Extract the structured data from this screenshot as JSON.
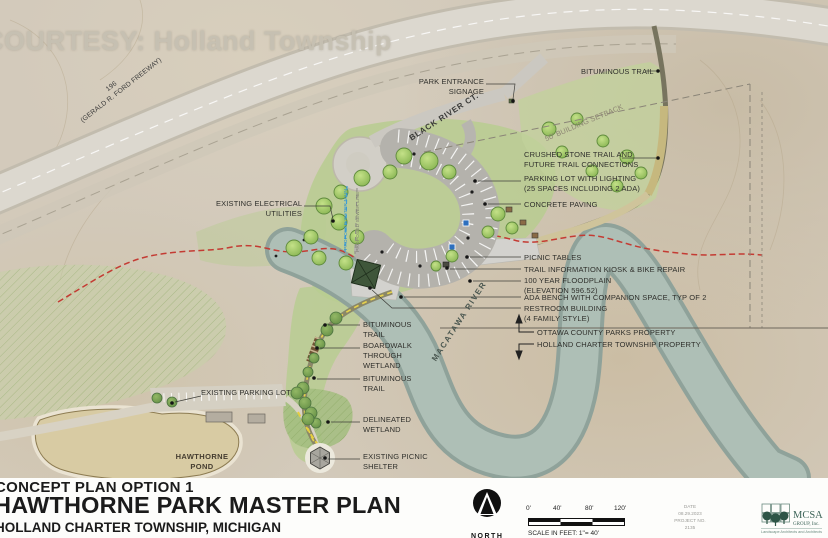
{
  "watermark": "COURTESY: Holland Township",
  "map": {
    "freeway_number": "196",
    "freeway_name": "(GERALD R. FORD FREEWAY)",
    "street_name": "BLACK RIVER CT.",
    "building_setback": "50' BUILDING SETBACK",
    "river_name": "MACATAWA RIVER",
    "pond_name_line1": "HAWTHORNE",
    "pond_name_line2": "POND",
    "water_main": "PROPOSED WATER MAIN",
    "sewer_line": "PROPOSED SEWER LINE"
  },
  "callouts": {
    "park_entrance": {
      "l1": "PARK ENTRANCE",
      "l2": "SIGNAGE"
    },
    "bituminous_trail_ne": {
      "l1": "BITUMINOUS TRAIL"
    },
    "crushed_stone": {
      "l1": "CRUSHED STONE TRAIL AND",
      "l2": "FUTURE TRAIL CONNECTIONS"
    },
    "parking_lot": {
      "l1": "PARKING LOT WITH LIGHTING",
      "l2": "(25 SPACES INCLUDING 2 ADA)"
    },
    "concrete_paving": {
      "l1": "CONCRETE PAVING"
    },
    "electrical": {
      "l1": "EXISTING ELECTRICAL",
      "l2": "UTILITIES"
    },
    "picnic_tables": {
      "l1": "PICNIC TABLES"
    },
    "kiosk": {
      "l1": "TRAIL INFORMATION KIOSK & BIKE REPAIR"
    },
    "floodplain": {
      "l1": "100 YEAR FLOODPLAIN",
      "l2": "(ELEVATION 596.52)"
    },
    "ada_bench": {
      "l1": "ADA BENCH WITH COMPANION SPACE, TYP OF 2"
    },
    "restroom": {
      "l1": "RESTROOM BUILDING",
      "l2": "(4 FAMILY STYLE)"
    },
    "ottawa_property": {
      "l1": "OTTAWA COUNTY PARKS PROPERTY"
    },
    "township_property": {
      "l1": "HOLLAND CHARTER TOWNSHIP PROPERTY"
    },
    "bituminous_trail_s1": {
      "l1": "BITUMINOUS",
      "l2": "TRAIL"
    },
    "boardwalk": {
      "l1": "BOARDWALK",
      "l2": "THROUGH",
      "l3": "WETLAND"
    },
    "bituminous_trail_s2": {
      "l1": "BITUMINOUS",
      "l2": "TRAIL"
    },
    "existing_parking": {
      "l1": "EXISTING PARKING LOT"
    },
    "delineated_wetland": {
      "l1": "DELINEATED",
      "l2": "WETLAND"
    },
    "existing_shelter": {
      "l1": "EXISTING PICNIC",
      "l2": "SHELTER"
    }
  },
  "title_block": {
    "option": "CONCEPT PLAN OPTION 1",
    "title": "HAWTHORNE PARK MASTER PLAN",
    "subtitle": "HOLLAND CHARTER TOWNSHIP, MICHIGAN",
    "north_label": "NORTH",
    "scale_ticks": [
      "0'",
      "40'",
      "80'",
      "120'"
    ],
    "scale_note": "SCALE IN FEET: 1\"= 40'",
    "date_label": "DATE",
    "date_value": "08.29.2023",
    "project_label": "PROJECT NO.",
    "project_value": "2135",
    "firm_name": "MCSA",
    "firm_suffix": "GROUP, Inc.",
    "firm_tagline": "Landscape Architects and Architects"
  },
  "colors": {
    "floodplain_line": "#c43b33",
    "river": "#aebfb6",
    "lawn": "#b9cc92",
    "proposed_trail_dash": "#e8d34b",
    "water_main_line": "#3fa0d8",
    "logo_green": "#3d6458"
  }
}
